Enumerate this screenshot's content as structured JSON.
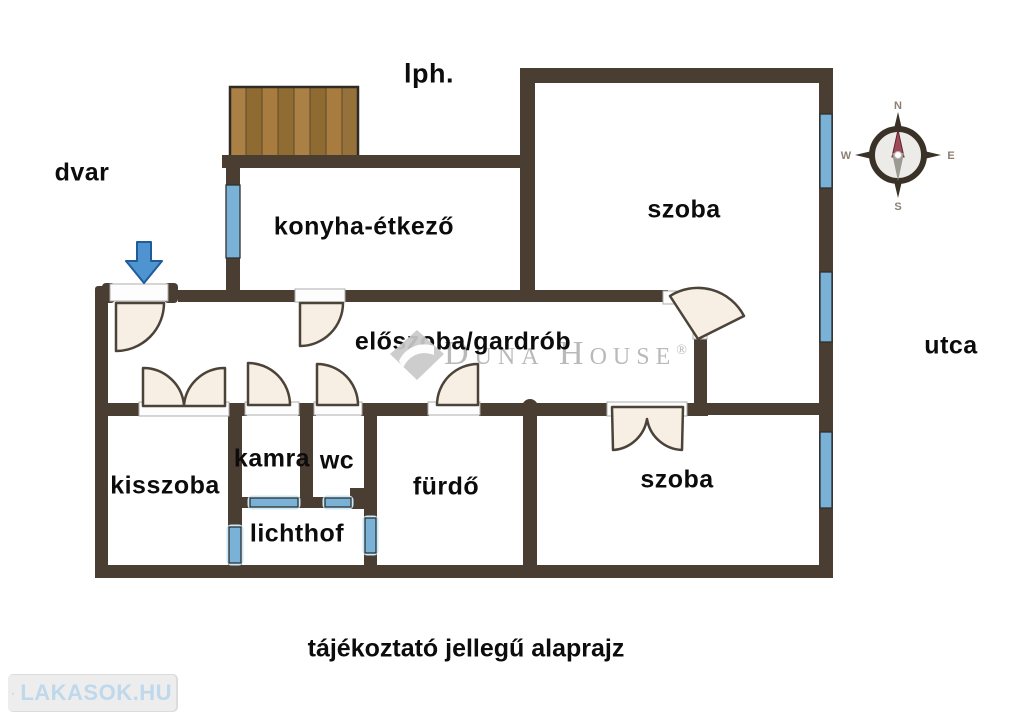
{
  "plan": {
    "labels": {
      "lph": "lph.",
      "dvar": "dvar",
      "konyha": "konyha-étkező",
      "szoba_top": "szoba",
      "utca": "utca",
      "eloszoba": "előszoba/gardrób",
      "kisszoba": "kisszoba",
      "kamra": "kamra",
      "wc": "wc",
      "furdo": "fürdő",
      "lichthof": "lichthof",
      "szoba_bottom": "szoba"
    },
    "caption": "tájékoztató jellegű alaprajz",
    "compass": {
      "n": "N",
      "e": "E",
      "s": "S",
      "w": "W"
    },
    "watermark": {
      "text": "Duna House",
      "registered": "®"
    },
    "logo": {
      "text": "LAKASOK.HU"
    },
    "colors": {
      "wall": "#4a3d32",
      "window_blue": "#7ab2d7",
      "window_glow": "#c9e9f6",
      "door_fill": "#f7efe4",
      "door_stroke": "#4b4238",
      "arrow_blue": "#4f94d0",
      "arrow_outline": "#1e5c9a",
      "wood_light": "#ab8045",
      "wood_dark": "#8f6a31",
      "watermark_gray": "#b9b9b9",
      "logo_blue": "#bfd8eb"
    }
  }
}
